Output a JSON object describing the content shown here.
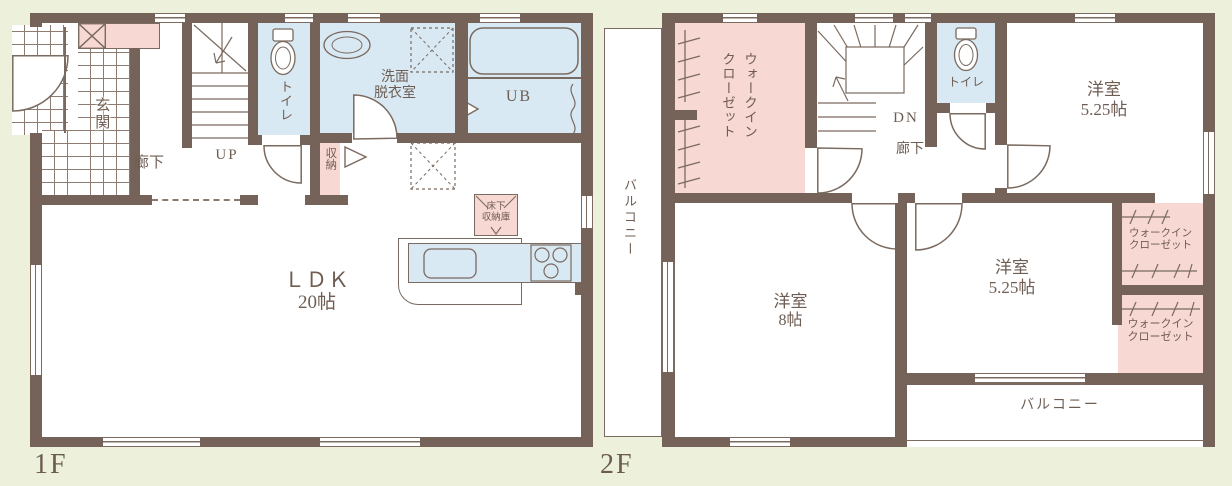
{
  "title": "floor-plan-1f-2f",
  "colors": {
    "wall": "#75635a",
    "pink": "#f7d8d3",
    "blue": "#d9e9f4",
    "background": "#edf1dc",
    "line": "#7a6a5f",
    "text": "#6e5d52"
  },
  "f1": {
    "floor_label": "1F",
    "genkan": "玄関",
    "hallway": "廊下",
    "stairs_dir": "UP",
    "toilet": "トイレ",
    "washroom_line1": "洗面",
    "washroom_line2": "脱衣室",
    "bath": "UB",
    "closet": "収納",
    "underfloor_line1": "床下",
    "underfloor_line2": "収納庫",
    "ldk_name": "ＬＤＫ",
    "ldk_size": "20帖"
  },
  "f2": {
    "floor_label": "2F",
    "balcony_left": "バルコニー",
    "wic_main_line1": "ウォークイン",
    "wic_main_line2": "クローゼット",
    "stairs_dir": "DN",
    "hallway": "廊下",
    "toilet": "トイレ",
    "room_ne_name": "洋室",
    "room_ne_size": "5.25帖",
    "wic_upper_line1": "ウォークイン",
    "wic_upper_line2": "クローゼット",
    "wic_lower_line1": "ウォークイン",
    "wic_lower_line2": "クローゼット",
    "room_sw_name": "洋室",
    "room_sw_size": "8帖",
    "room_se_name": "洋室",
    "room_se_size": "5.25帖",
    "balcony_bottom": "バルコニー"
  }
}
